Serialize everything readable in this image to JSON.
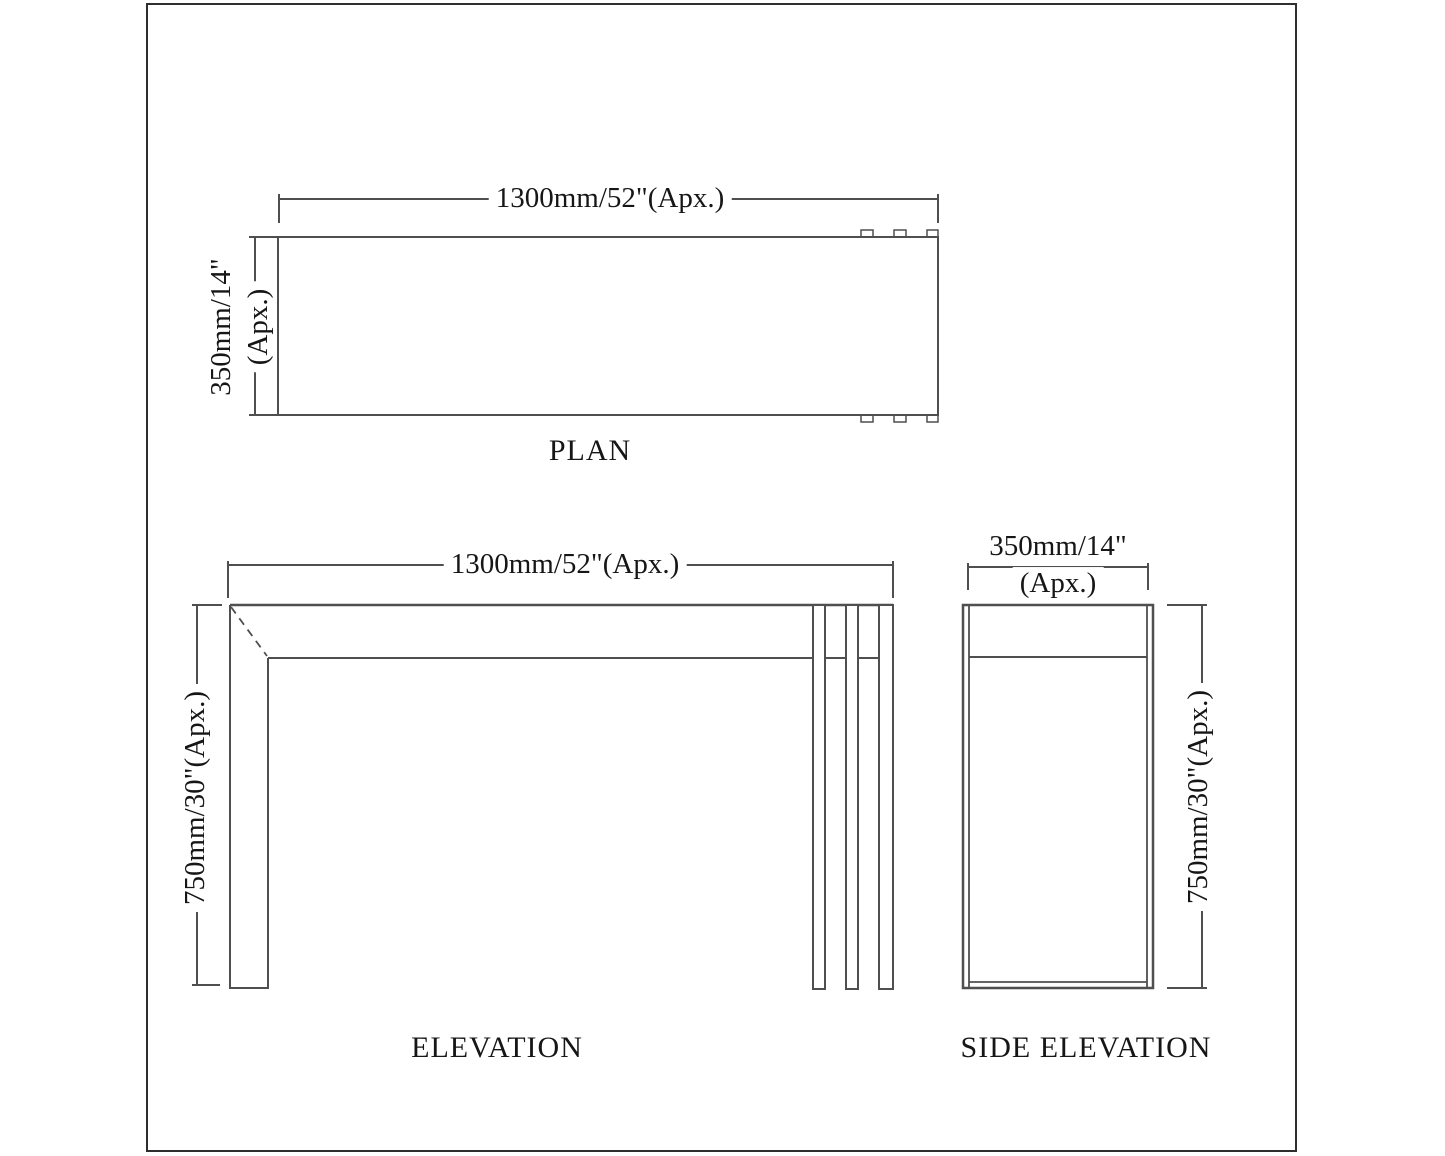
{
  "views": {
    "plan": {
      "label": "PLAN",
      "width_dim": "1300mm/52\"(Apx.)",
      "depth_dim_line1": "350mm/14\"",
      "depth_dim_line2": "(Apx.)"
    },
    "elevation": {
      "label": "ELEVATION",
      "width_dim": "1300mm/52\"(Apx.)",
      "height_dim": "750mm/30\"(Apx.)"
    },
    "side_elevation": {
      "label": "SIDE ELEVATION",
      "width_dim_line1": "350mm/14\"",
      "width_dim_line2": "(Apx.)",
      "height_dim": "750mm/30\"(Apx.)"
    }
  },
  "colors": {
    "line": "#4f4f4f",
    "text": "#161616",
    "sheet_border": "#2e2e2e",
    "background": "#ffffff"
  }
}
